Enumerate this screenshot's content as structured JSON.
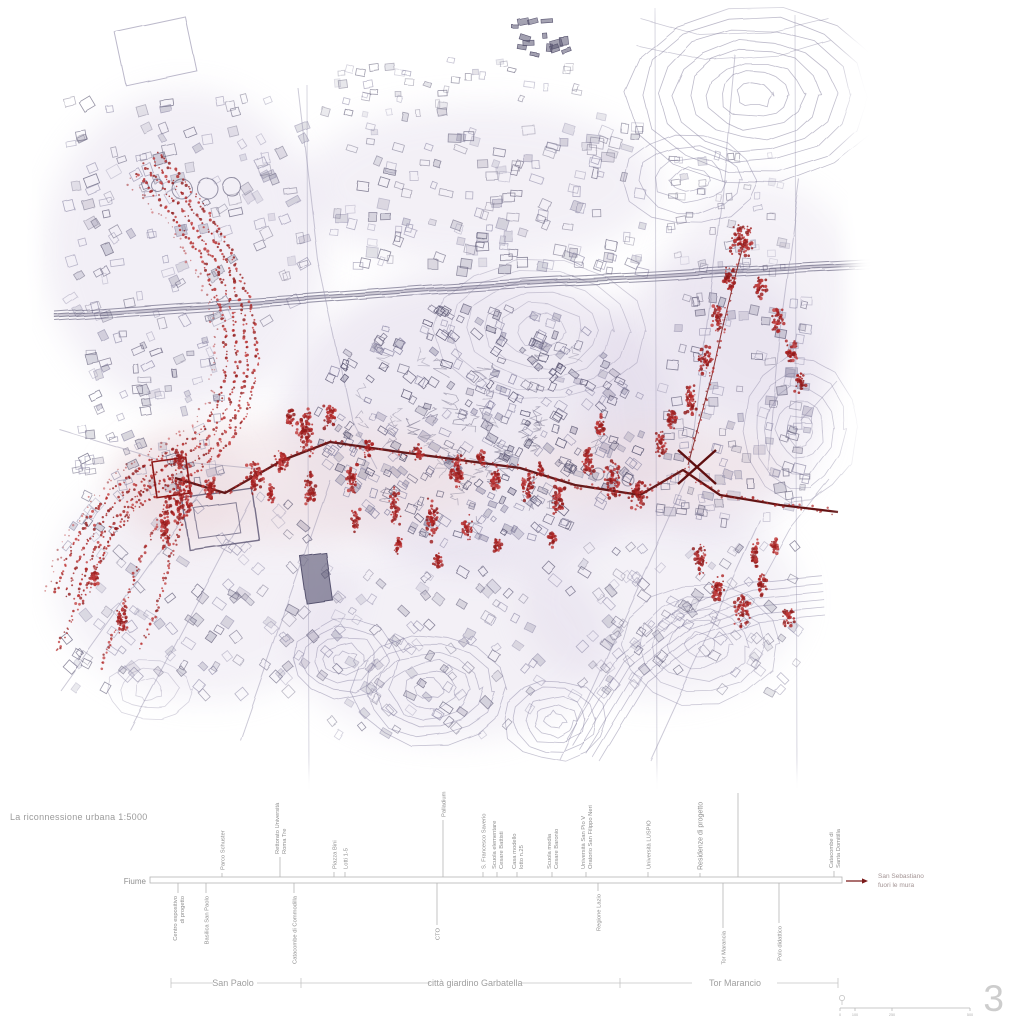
{
  "title": "La riconnessione urbana 1:5000",
  "page_number": "3",
  "colors": {
    "red": "#9e1f1f",
    "red_dark": "#5f0f10",
    "red_mid": "#b02626",
    "ink": "#57536f",
    "ink_light": "#8d89a6",
    "contour": "#7d7898",
    "wash": "#d5cbe2",
    "wash_pink": "#eddce0",
    "label": "#8f8f8f",
    "label_light": "#a0a0a0",
    "line": "#b5b5b5",
    "dest_text": "#a39494"
  },
  "timeline": {
    "river_label": "Fiume",
    "bar": {
      "x1": 150,
      "x2": 842,
      "y_top": 877,
      "y_bottom": 883
    },
    "ticks_above": [
      {
        "x": 222,
        "tick": 4,
        "lines": [
          "Parco Schuster"
        ]
      },
      {
        "x": 280,
        "tick": 20,
        "lines": [
          "Rettorato Università",
          "Roma Tre"
        ]
      },
      {
        "x": 334,
        "tick": 5,
        "lines": [
          "Piazza Bini"
        ]
      },
      {
        "x": 345,
        "tick": 5,
        "lines": [
          "Lotti 1-5"
        ]
      },
      {
        "x": 443,
        "tick": 57,
        "lines": [
          "Palladium"
        ]
      },
      {
        "x": 483,
        "tick": 5,
        "lines": [
          "S. Francesco Saverio"
        ]
      },
      {
        "x": 497,
        "tick": 5,
        "lines": [
          "Scuola elementare",
          "Cesare Battisti"
        ]
      },
      {
        "x": 517,
        "tick": 5,
        "lines": [
          "Casa modello",
          "lotto n.25"
        ]
      },
      {
        "x": 552,
        "tick": 5,
        "lines": [
          "Scuola media",
          "Cesare Baronio"
        ]
      },
      {
        "x": 586,
        "tick": 5,
        "lines": [
          "Università San Pio V",
          "Oratorio San Filippo Neri"
        ]
      },
      {
        "x": 648,
        "tick": 5,
        "lines": [
          "Università LUSPIO"
        ]
      },
      {
        "x": 700,
        "tick": 4,
        "lines": [
          "Residenze di progetto"
        ],
        "big": true
      },
      {
        "x": 738,
        "tick": 84,
        "lines": []
      },
      {
        "x": 834,
        "tick": 6,
        "lines": [
          "Catacombe di",
          "Santa Domitilla"
        ]
      }
    ],
    "ticks_below": [
      {
        "x": 178,
        "tick": 10,
        "lines": [
          "Centro espositivo",
          "di progetto"
        ]
      },
      {
        "x": 206,
        "tick": 10,
        "lines": [
          "Basilica San Paolo"
        ]
      },
      {
        "x": 294,
        "tick": 10,
        "lines": [
          "Catacombe di Commodilla"
        ]
      },
      {
        "x": 437,
        "tick": 42,
        "lines": [
          "CTO"
        ]
      },
      {
        "x": 598,
        "tick": 8,
        "lines": [
          "Regione Lazio"
        ]
      },
      {
        "x": 723,
        "tick": 45,
        "lines": [
          "Tor Marancia"
        ]
      },
      {
        "x": 779,
        "tick": 40,
        "lines": [
          "Polo didattico"
        ]
      }
    ],
    "destination": {
      "lines": [
        "San Sebastiano",
        "fuori le mura"
      ],
      "text_x": 878,
      "y": 881,
      "arrow_x1": 846,
      "arrow_x2": 868
    },
    "sections": {
      "y": 983,
      "segments": [
        [
          171,
          213
        ],
        [
          257,
          430
        ],
        [
          522,
          692
        ],
        [
          777,
          838
        ]
      ],
      "ticks": [
        171,
        301,
        620,
        838
      ],
      "items": [
        {
          "label": "San Paolo",
          "x": 233
        },
        {
          "label": "città giardino Garbatella",
          "x": 475
        },
        {
          "label": "Tor Marancio",
          "x": 735
        }
      ]
    }
  },
  "scalebar": {
    "x1": 840,
    "x2": 970,
    "y": 1008,
    "ticks": [
      {
        "x": 840,
        "label": "0"
      },
      {
        "x": 855,
        "label": "100"
      },
      {
        "x": 892,
        "label": "250"
      },
      {
        "x": 970,
        "label": "500"
      }
    ]
  }
}
